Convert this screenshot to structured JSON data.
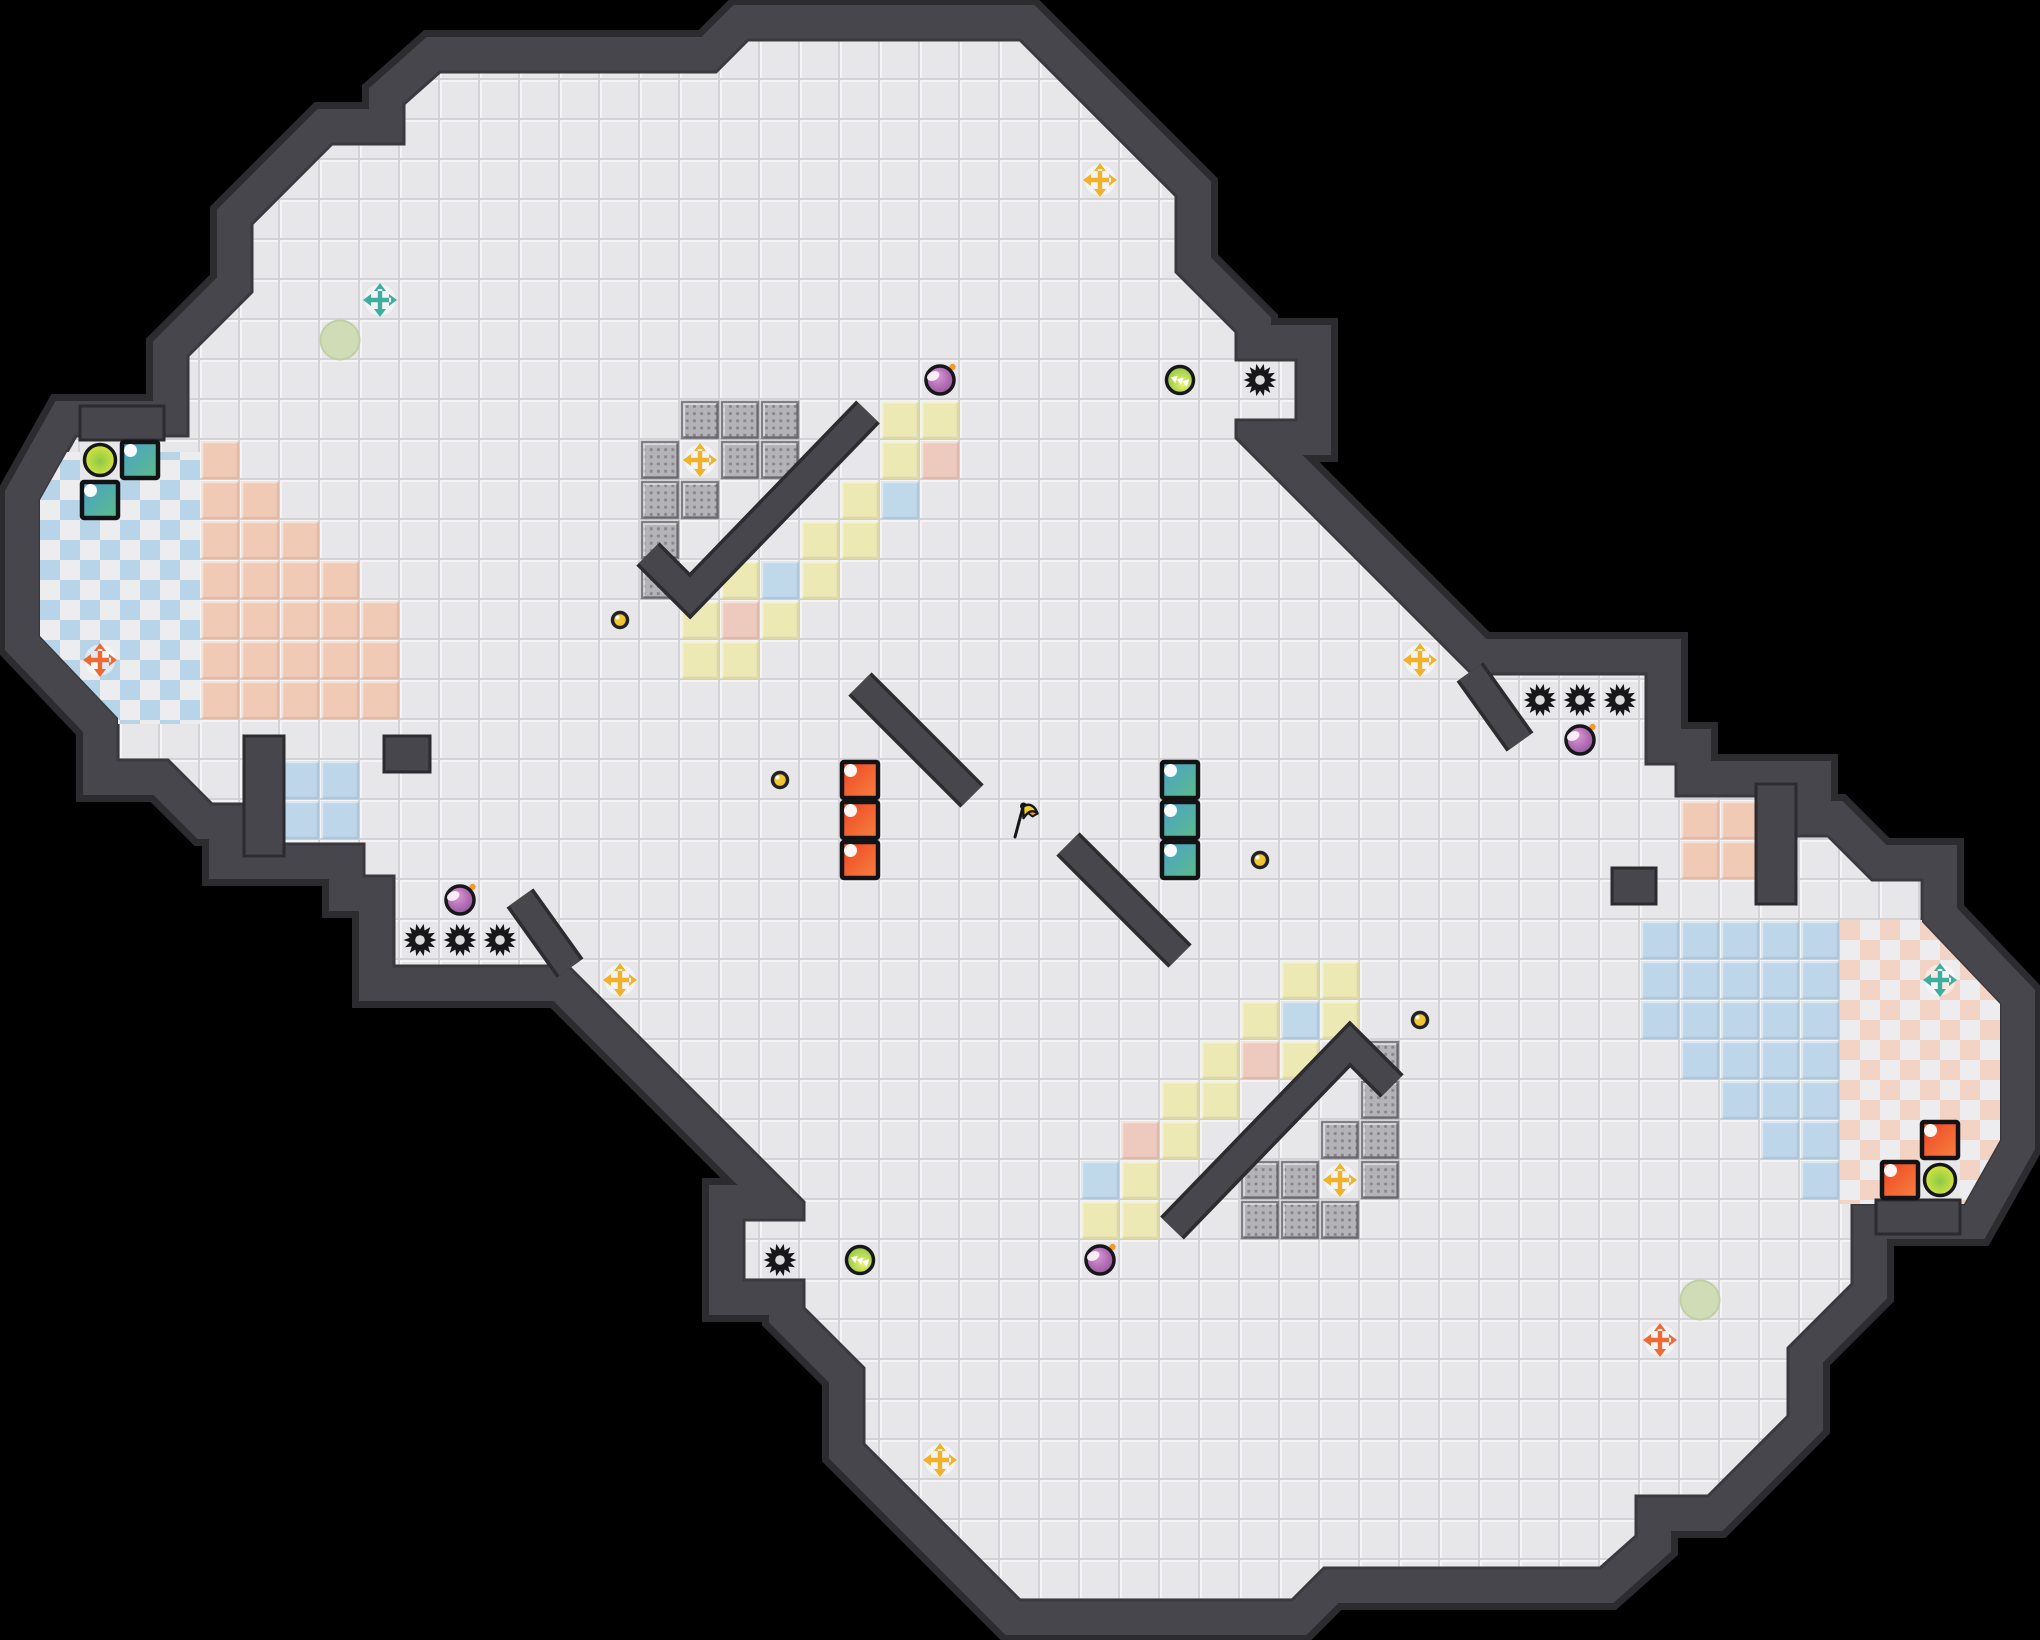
{
  "meta": {
    "width": 2040,
    "height": 1640,
    "tile": 40,
    "style": "top-down capture-the-flag arena map"
  },
  "colors": {
    "background": "#000000",
    "wall": "#46464c",
    "wall_outline": "#2b2b30",
    "wall_inner_edge": "#39393f",
    "floor": "#e7e7ea",
    "floor_hi": "#f4f4f6",
    "floor_lo": "#d2d2d7",
    "tile_yellow": "#ede9b5",
    "tile_pink": "#eec9bd",
    "tile_blue": "#bfd8ea",
    "team_red_tile": "#f0cab5",
    "team_blue_tile": "#bdd6e9",
    "checker_blue": "#b7d4e9",
    "checker_salmon": "#f3d3c4",
    "checker_white": "#ededef",
    "block_base": "#b3b3b8",
    "block_dot": "#85858c",
    "block_border": "#7e7e84",
    "bomb_light": "#e3a0d8",
    "bomb_dark": "#8a4597",
    "fuse_orange": "#f49a2a",
    "boost_yellow": "#f0f26a",
    "boost_green": "#7fc23f",
    "powerup_yellow": "#e9ed3c",
    "powerup_green": "#8cc84a",
    "soft_circle": "#cfdcb4",
    "soft_circle_rim": "#bccf9e",
    "button_yellow": "#f3c52f",
    "cross_yellow": "#f0b22b",
    "cross_teal": "#3fae9f",
    "cross_orange": "#ee6a35",
    "gate_red_a": "#ee4423",
    "gate_red_b": "#f5813f",
    "gate_teal_a": "#4aa0cf",
    "gate_teal_b": "#5cbd85",
    "gate_border": "#131316",
    "flag_yellow": "#f2cf2a",
    "flag_orange": "#f0a41e",
    "ink": "#17171a"
  },
  "map": {
    "boundary_half": [
      [
        14.2,
        24.15
      ],
      [
        9.85,
        24.15
      ],
      [
        9.85,
        21.9
      ],
      [
        9.1,
        21.9
      ],
      [
        9.1,
        21.1
      ],
      [
        6.1,
        21.1
      ],
      [
        6.1,
        20.1
      ],
      [
        5.3,
        20.1
      ],
      [
        4.2,
        19.0
      ],
      [
        2.95,
        19.0
      ],
      [
        2.95,
        17.95
      ],
      [
        1.0,
        15.9
      ],
      [
        1.0,
        12.5
      ],
      [
        1.9,
        10.9
      ],
      [
        4.7,
        10.9
      ],
      [
        4.7,
        8.9
      ],
      [
        6.3,
        7.3
      ],
      [
        6.3,
        5.6
      ],
      [
        8.3,
        3.6
      ],
      [
        10.1,
        3.6
      ],
      [
        10.1,
        2.6
      ],
      [
        11.0,
        1.8
      ],
      [
        17.9,
        1.8
      ],
      [
        18.7,
        1.0
      ],
      [
        25.5,
        1.0
      ],
      [
        29.4,
        4.9
      ],
      [
        29.4,
        6.8
      ],
      [
        30.9,
        8.3
      ],
      [
        30.9,
        9.0
      ],
      [
        32.4,
        9.0
      ],
      [
        32.4,
        10.5
      ],
      [
        30.9,
        10.5
      ],
      [
        30.9,
        10.95
      ],
      [
        36.8,
        16.85
      ]
    ],
    "inner_wall_lines": [
      {
        "pts": [
          [
            21.7,
            10.3
          ],
          [
            17.25,
            14.9
          ],
          [
            16.2,
            13.85
          ]
        ]
      },
      {
        "pts": [
          [
            29.3,
            30.7
          ],
          [
            33.75,
            26.1
          ],
          [
            34.8,
            27.15
          ]
        ]
      },
      {
        "pts": [
          [
            21.5,
            17.1
          ],
          [
            24.3,
            19.9
          ]
        ]
      },
      {
        "pts": [
          [
            29.5,
            23.9
          ],
          [
            26.7,
            21.1
          ]
        ]
      },
      {
        "pts": [
          [
            36.75,
            16.8
          ],
          [
            38.0,
            18.55
          ]
        ]
      },
      {
        "pts": [
          [
            14.25,
            24.2
          ],
          [
            13.0,
            22.45
          ]
        ]
      }
    ],
    "inner_wall_rects": [
      [
        9.6,
        18.4,
        1.15,
        0.9
      ],
      [
        6.1,
        18.4,
        1.0,
        3.0
      ],
      [
        2.0,
        10.15,
        2.1,
        0.85
      ],
      [
        40.3,
        21.7,
        1.1,
        0.9
      ],
      [
        43.9,
        19.6,
        1.0,
        3.0
      ],
      [
        46.9,
        30.0,
        2.1,
        0.85
      ]
    ],
    "checker_blue_zone": [
      1.0,
      11.3,
      4.0,
      6.8
    ],
    "checker_red_zone": [
      46.0,
      23.0,
      4.0,
      7.1
    ],
    "gray_patches": [
      [
        2,
        11,
        2,
        1
      ],
      [
        2,
        12,
        1,
        1
      ],
      [
        47,
        29,
        2,
        1
      ],
      [
        48,
        28,
        1,
        1
      ]
    ],
    "team_red_regions": [
      [
        5,
        11,
        1,
        1
      ],
      [
        5,
        12,
        2,
        1
      ],
      [
        5,
        13,
        3,
        1
      ],
      [
        5,
        14,
        4,
        1
      ],
      [
        5,
        15,
        5,
        3
      ],
      [
        42,
        20,
        2,
        2
      ]
    ],
    "team_blue_regions": [
      [
        45,
        29,
        1,
        1
      ],
      [
        44,
        28,
        2,
        1
      ],
      [
        43,
        27,
        3,
        1
      ],
      [
        42,
        26,
        4,
        1
      ],
      [
        41,
        23,
        5,
        3
      ],
      [
        7,
        19,
        2,
        2
      ]
    ],
    "speed_tiles_yellow": [
      [
        17,
        16
      ],
      [
        18,
        16
      ],
      [
        17,
        15
      ],
      [
        19,
        15
      ],
      [
        18,
        14
      ],
      [
        20,
        14
      ],
      [
        20,
        13
      ],
      [
        21,
        13
      ],
      [
        21,
        12
      ],
      [
        22,
        11
      ],
      [
        22,
        10
      ],
      [
        23,
        10
      ],
      [
        33,
        24
      ],
      [
        32,
        24
      ],
      [
        33,
        25
      ],
      [
        31,
        25
      ],
      [
        32,
        26
      ],
      [
        30,
        26
      ],
      [
        30,
        27
      ],
      [
        29,
        27
      ],
      [
        29,
        28
      ],
      [
        28,
        29
      ],
      [
        28,
        30
      ],
      [
        27,
        30
      ]
    ],
    "speed_tiles_pink": [
      [
        18,
        15
      ],
      [
        23,
        11
      ],
      [
        31,
        26
      ],
      [
        28,
        28
      ]
    ],
    "speed_tiles_blue": [
      [
        19,
        14
      ],
      [
        22,
        12
      ],
      [
        32,
        25
      ],
      [
        27,
        29
      ]
    ],
    "blocks": [
      [
        17,
        10
      ],
      [
        18,
        10
      ],
      [
        19,
        10
      ],
      [
        16,
        11
      ],
      [
        18,
        11
      ],
      [
        19,
        11
      ],
      [
        16,
        12
      ],
      [
        17,
        12
      ],
      [
        16,
        13
      ],
      [
        16,
        14
      ],
      [
        33,
        30
      ],
      [
        32,
        30
      ],
      [
        31,
        30
      ],
      [
        34,
        29
      ],
      [
        32,
        29
      ],
      [
        31,
        29
      ],
      [
        34,
        28
      ],
      [
        33,
        28
      ],
      [
        34,
        27
      ],
      [
        34,
        26
      ]
    ]
  },
  "objects": {
    "flag": {
      "pos": [
        25,
        20
      ]
    },
    "spikes": [
      [
        31,
        9
      ],
      [
        38,
        17
      ],
      [
        39,
        17
      ],
      [
        40,
        17
      ],
      [
        10,
        23
      ],
      [
        11,
        23
      ],
      [
        12,
        23
      ],
      [
        19,
        31
      ]
    ],
    "bombs": [
      [
        23,
        9
      ],
      [
        39,
        18
      ],
      [
        11,
        22
      ],
      [
        27,
        31
      ]
    ],
    "boosts": [
      [
        29,
        9
      ],
      [
        21,
        31
      ]
    ],
    "powerups": [
      [
        2,
        11
      ],
      [
        48,
        29
      ]
    ],
    "soft_circles": [
      [
        8,
        8
      ],
      [
        42,
        32
      ]
    ],
    "buttons": [
      [
        15,
        15
      ],
      [
        19,
        19
      ],
      [
        31,
        21
      ],
      [
        35,
        25
      ]
    ],
    "crosses": [
      {
        "pos": [
          27,
          4
        ],
        "team": "yellow"
      },
      {
        "pos": [
          17,
          11
        ],
        "team": "yellow"
      },
      {
        "pos": [
          35,
          16
        ],
        "team": "yellow"
      },
      {
        "pos": [
          15,
          24
        ],
        "team": "yellow"
      },
      {
        "pos": [
          33,
          29
        ],
        "team": "yellow"
      },
      {
        "pos": [
          23,
          36
        ],
        "team": "yellow"
      },
      {
        "pos": [
          9,
          7
        ],
        "team": "teal"
      },
      {
        "pos": [
          48,
          24
        ],
        "team": "teal"
      },
      {
        "pos": [
          2,
          16
        ],
        "team": "orange"
      },
      {
        "pos": [
          41,
          33
        ],
        "team": "orange"
      }
    ],
    "gates_red": [
      [
        21,
        19
      ],
      [
        21,
        20
      ],
      [
        21,
        21
      ],
      [
        48,
        28
      ],
      [
        47,
        29
      ]
    ],
    "gates_teal": [
      [
        29,
        19
      ],
      [
        29,
        20
      ],
      [
        29,
        21
      ],
      [
        3,
        11
      ],
      [
        2,
        12
      ]
    ]
  },
  "icons": [
    "spike-icon",
    "bomb-icon",
    "boost-icon",
    "powerup-icon",
    "button-icon",
    "flag-icon",
    "spawn-cross-icon"
  ]
}
